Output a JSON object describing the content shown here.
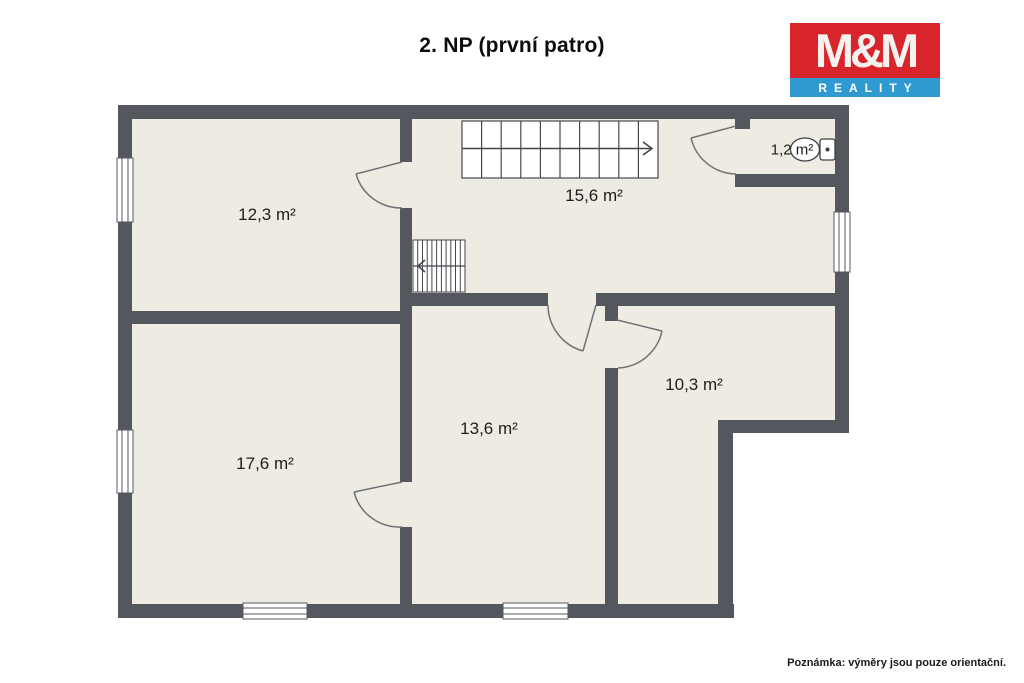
{
  "title": "2. NP (první patro)",
  "floor_plan": {
    "rooms": [
      {
        "name": "room-top-left",
        "area_label": "12,3 m²"
      },
      {
        "name": "hall-staircase",
        "area_label": "15,6 m²"
      },
      {
        "name": "wc",
        "area_label": "1,2 m²"
      },
      {
        "name": "room-bottom-left",
        "area_label": "17,6 m²"
      },
      {
        "name": "room-center",
        "area_label": "13,6 m²"
      },
      {
        "name": "room-right",
        "area_label": "10,3 m²"
      }
    ],
    "features": [
      "staircase-main-arrow-right",
      "staircase-upper-arrow-left",
      "toilet-icon",
      "5-windows",
      "5-door-swings"
    ]
  },
  "logo": {
    "top": "M&M",
    "bottom": "REALITY"
  },
  "note": "Poznámka: výměry jsou pouze orientační.",
  "colors": {
    "wall": "#54575e",
    "floor": "#edebe2",
    "background": "#ffffff",
    "door_line": "#6f7277",
    "logo_red": "#d8252c",
    "logo_blue": "#2f9ad2"
  }
}
